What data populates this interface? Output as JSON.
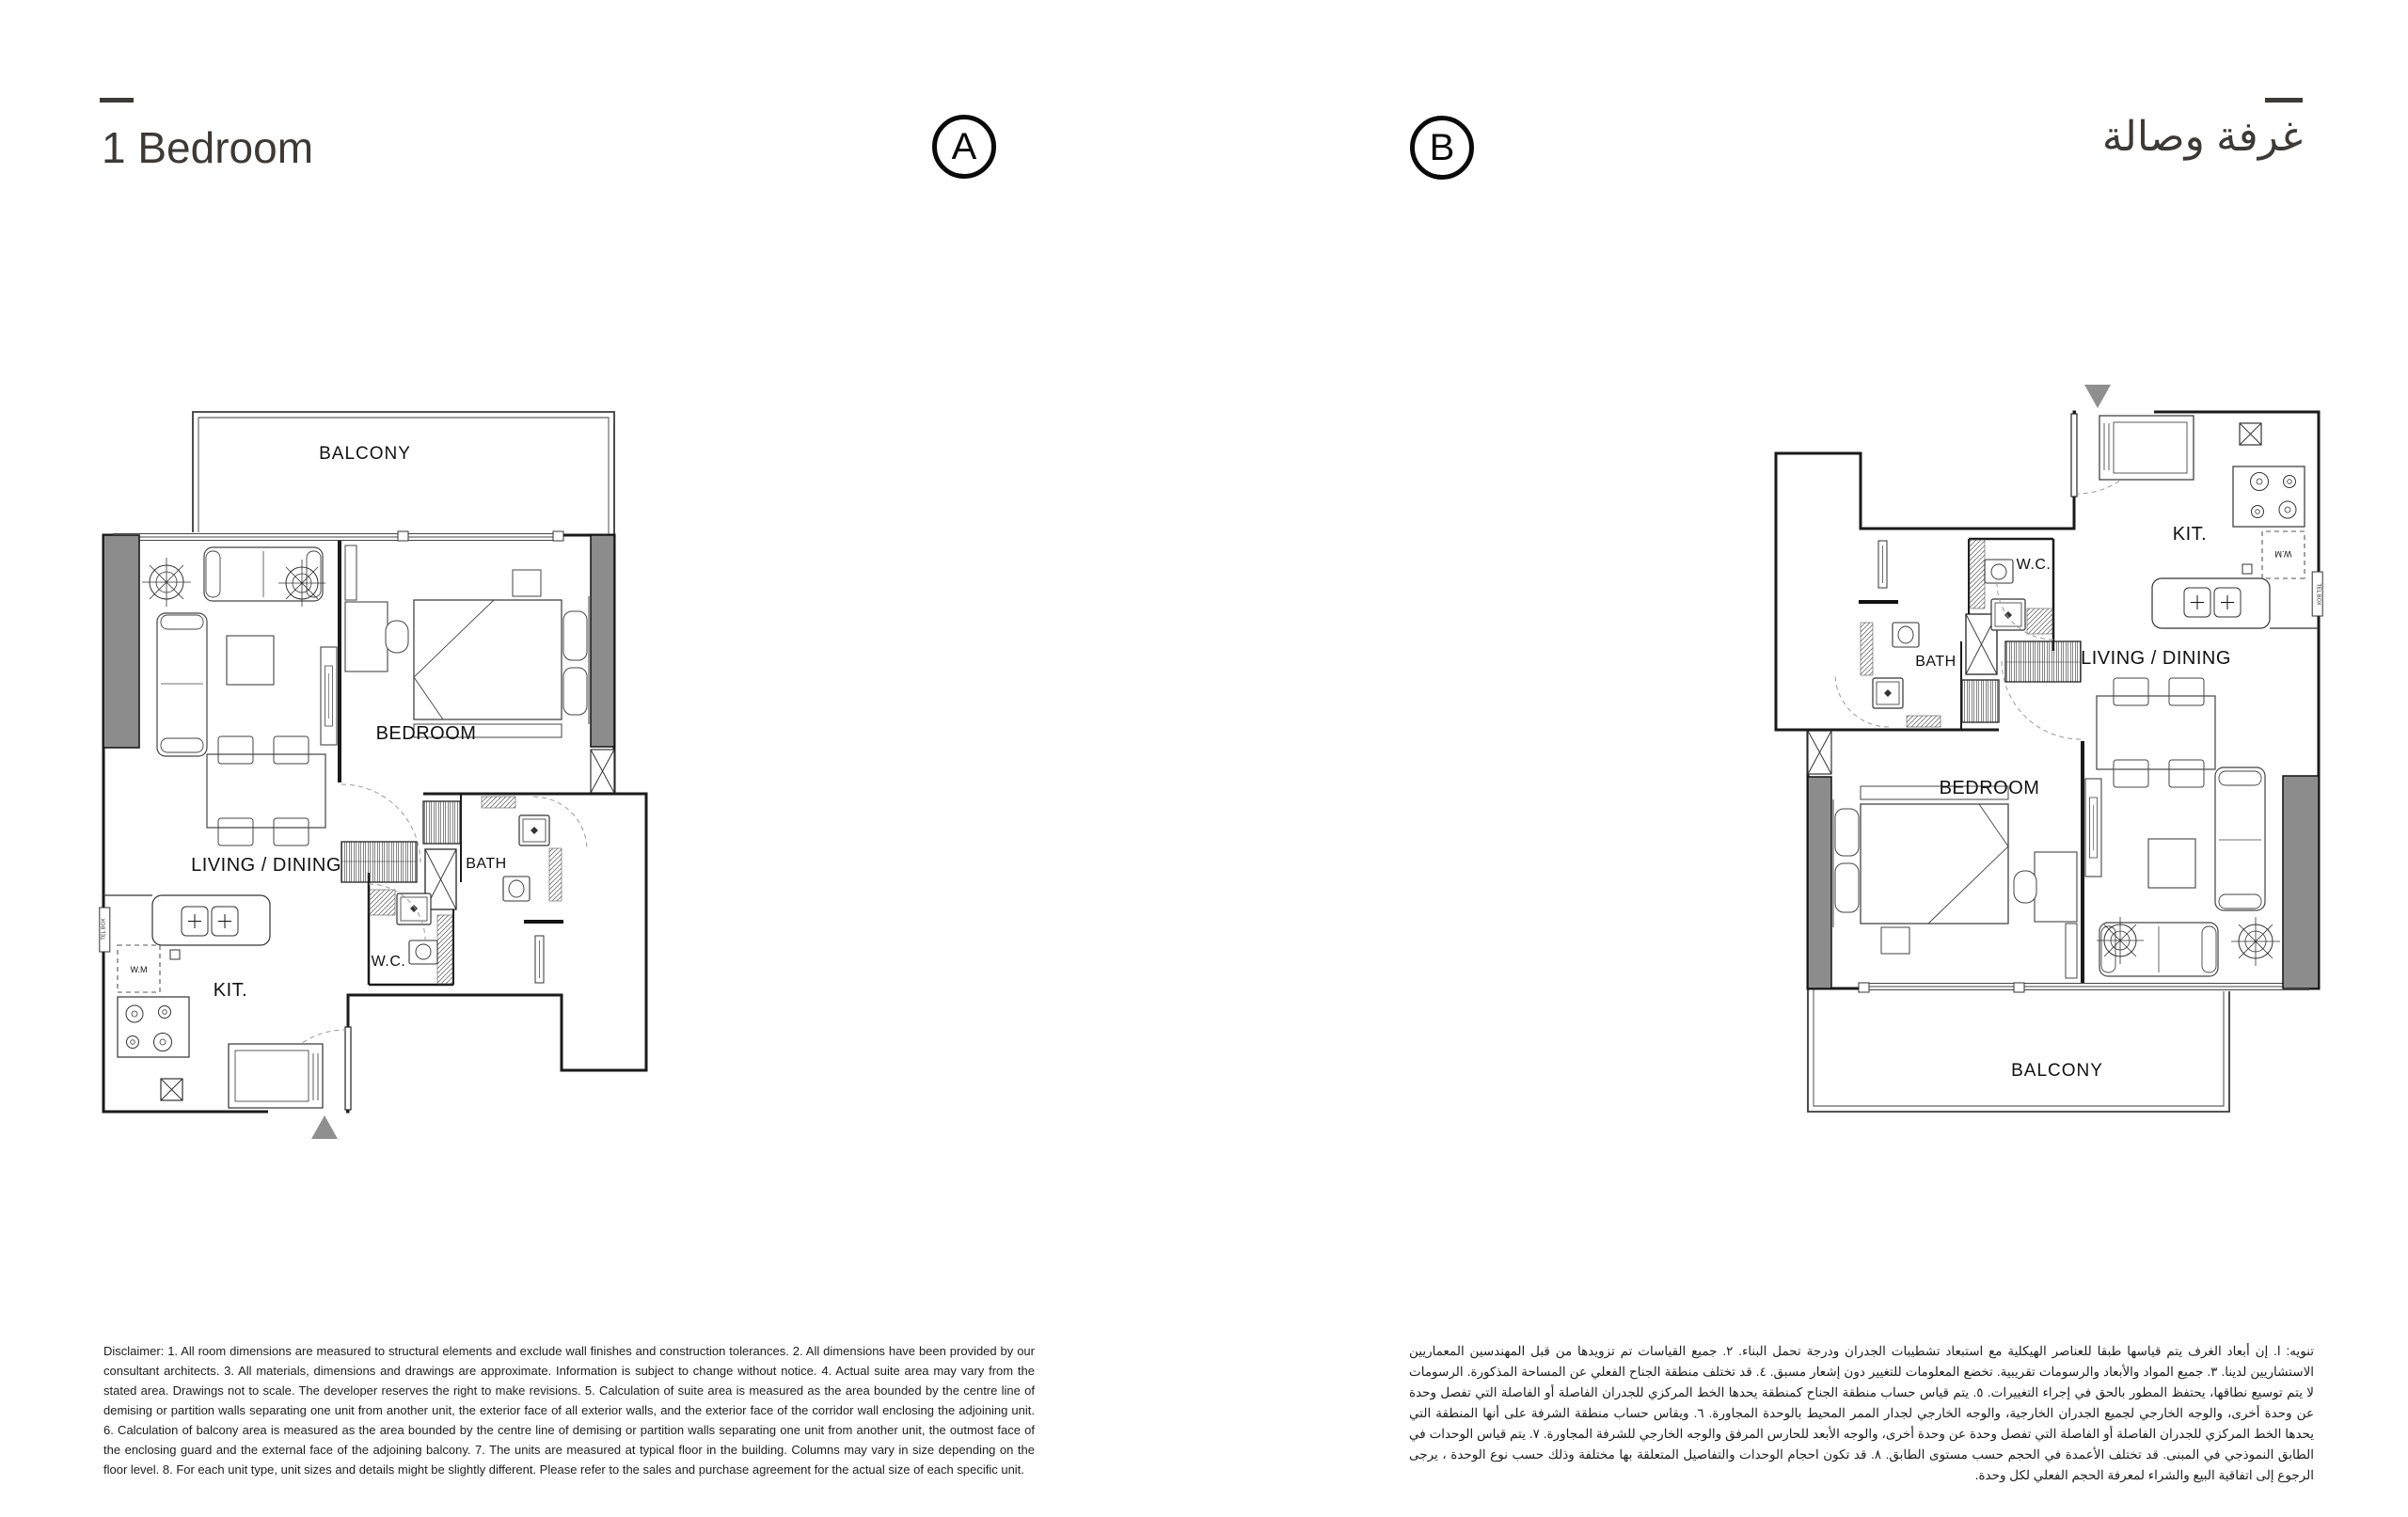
{
  "header": {
    "title_en": "1 Bedroom",
    "title_ar": "غرفة وصالة",
    "unit_a_label": "A",
    "unit_b_label": "B"
  },
  "plans": {
    "shared": {
      "wm_label": "W.M",
      "tel_box_label": "TEL BOX"
    },
    "a": {
      "balcony": "BALCONY",
      "bedroom": "BEDROOM",
      "living_dining": "LIVING / DINING",
      "kitchen": "KIT.",
      "wc": "W.C.",
      "bath": "BATH"
    },
    "b": {
      "balcony": "BALCONY",
      "bedroom": "BEDROOM",
      "living_dining": "LIVING / DINING",
      "kitchen": "KIT.",
      "wc": "W.C.",
      "bath": "BATH"
    }
  },
  "disclaimers": {
    "en": "Disclaimer: 1. All room dimensions are measured to structural elements and exclude wall finishes and construction tolerances. 2. All dimensions have been provided by our consultant architects. 3. All materials, dimensions and drawings are approximate. Information is subject to change without notice. 4. Actual suite area may vary from the stated area. Drawings not to scale. The developer reserves the right to make revisions. 5. Calculation of suite area is measured as the area bounded by the centre line of demising or partition walls separating one unit from another unit, the exterior face of all exterior walls, and the exterior face of the corridor wall enclosing the adjoining unit. 6. Calculation of balcony area is measured as the area bounded by the centre line of demising or partition walls separating one unit from another unit, the outmost face of the enclosing guard and the external face of the adjoining balcony. 7. The units are measured at typical floor in the building. Columns may vary in size depending on the floor level. 8. For each unit type, unit sizes and details might be slightly different. Please refer to the sales and purchase agreement for the actual size of each specific unit.",
    "ar": "تنويه: ا. إن أبعاد الغرف يتم قياسها طبقا للعناصر الهيكلية مع استبعاد تشطيبات الجدران ودرجة تحمل البناء. ٢. جميع القياسات تم تزويدها من قبل المهندسين المعماريين الاستشاريين لدينا. ٣. جميع المواد والأبعاد والرسومات تقريبية. تخضع المعلومات للتغيير دون إشعار مسبق. ٤. قد تختلف منطقة الجناح الفعلي عن المساحة المذكورة. الرسومات لا يتم توسيع نطاقها، يحتفظ المطور بالحق في إجراء التغييرات. ٥. يتم قياس حساب منطقة الجناح كمنطقة يحدها الخط المركزي للجدران الفاصلة أو الفاصلة التي تفصل وحدة عن وحدة أخرى، والوجه الخارجي لجميع الجدران الخارجية، والوجه الخارجي لجدار الممر المحيط بالوحدة المجاورة. ٦. ويقاس حساب منطقة الشرفة على أنها المنطقة التي يحدها الخط المركزي للجدران الفاصلة أو الفاصلة التي تفصل وحدة عن وحدة أخرى، والوجه الأبعد للحارس المرفق والوجه الخارجي للشرفة المجاورة. ٧. يتم قياس الوحدات في الطابق النموذجي في المبنى. قد تختلف الأعمدة في الحجم حسب مستوى الطابق. ٨. قد تكون احجام الوحدات والتفاصيل المتعلقة بها مختلفة وذلك حسب نوع الوحدة ، يرجى الرجوع إلى اتفاقية البيع والشراء لمعرفة الحجم الفعلي لكل وحدة."
  },
  "colors": {
    "title_text": "#3e3935",
    "plan_line": "#1a1a1a",
    "column_fill": "#8c8c8c",
    "arrow_fill": "#8f8f8f"
  }
}
